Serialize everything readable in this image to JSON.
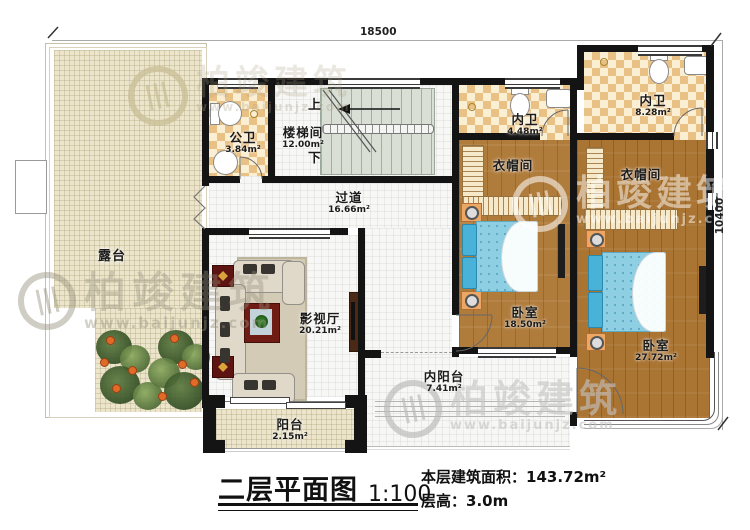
{
  "plan": {
    "dim_top": "18500",
    "dim_right": "10400",
    "stairs_up": "上",
    "stairs_down": "下"
  },
  "rooms": {
    "terrace": {
      "name": "露台"
    },
    "public_bath": {
      "name": "公卫",
      "area": "3.84m²"
    },
    "stairwell": {
      "name": "楼梯间",
      "area": "12.00m²"
    },
    "corridor": {
      "name": "过道",
      "area": "16.66m²"
    },
    "en_suite_bath_1": {
      "name": "内卫",
      "area": "4.48m²"
    },
    "en_suite_bath_2": {
      "name": "内卫",
      "area": "8.28m²"
    },
    "closet_1": {
      "name": "衣帽间"
    },
    "closet_2": {
      "name": "衣帽间"
    },
    "bedroom_1": {
      "name": "卧室",
      "area": "18.50m²"
    },
    "bedroom_2": {
      "name": "卧室",
      "area": "27.72m²"
    },
    "media_room": {
      "name": "影视厅",
      "area": "20.21m²"
    },
    "inner_balcony": {
      "name": "内阳台",
      "area": "7.41m²"
    },
    "balcony": {
      "name": "阳台",
      "area": "2.15m²"
    }
  },
  "title_block": {
    "title": "二层平面图",
    "scale": "1:100",
    "floor_area_label": "本层建筑面积：",
    "floor_area_value": "143.72m²",
    "floor_height_label": "层高：",
    "floor_height_value": "3.0m"
  },
  "watermark": {
    "brand": "柏竣建筑",
    "url": "www.baijunjz.com"
  },
  "colors": {
    "wall": "#141414",
    "wood": "#b07c3c",
    "tile_light": "#faefd2",
    "tile_dark": "#eac185",
    "terrace": "#ece5cc",
    "stair": "#d9dfd5",
    "bed": "#8ecfe4",
    "accent_red": "#6e1c14"
  }
}
